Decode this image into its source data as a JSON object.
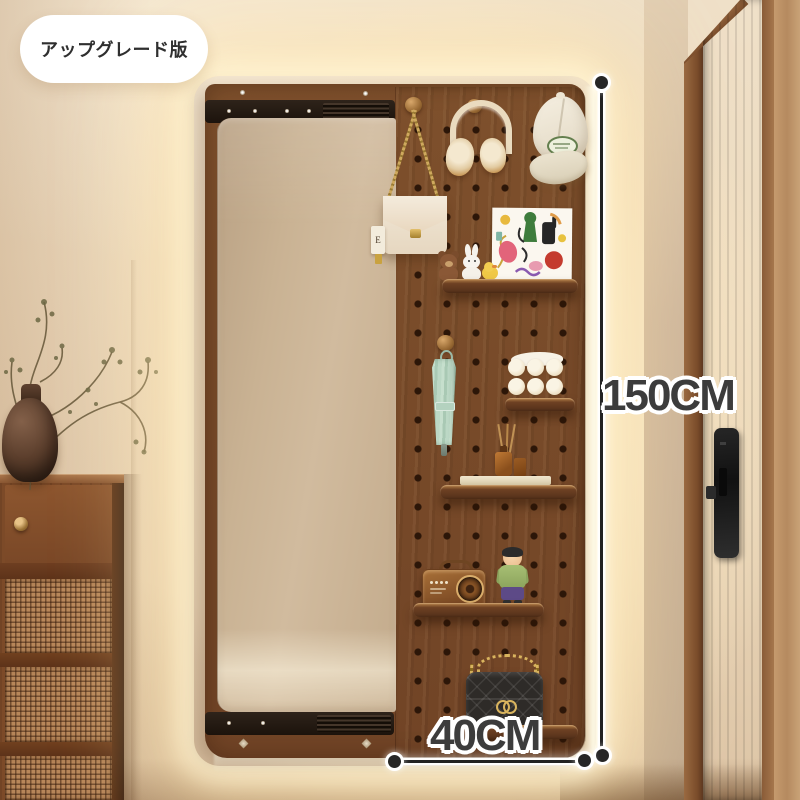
{
  "badge": {
    "label": "アップグレード版"
  },
  "annotations": {
    "height": {
      "label": "150CM"
    },
    "width": {
      "label": "40CM"
    }
  },
  "bag": {
    "tag_letter": "E"
  },
  "colors": {
    "wall": "#eedcc3",
    "glow": "#fff6dc",
    "pegboard_wood": "#85552e",
    "dark_wood": "#5a3820",
    "mirror": "#ccb698",
    "mint_umbrella": "#b9d6c2",
    "gold": "#c9a24a",
    "annotation_text": "#3c3c3c",
    "annotation_outline": "#ffffff",
    "badge_bg": "#ffffff",
    "badge_text": "#2f2f2f"
  }
}
